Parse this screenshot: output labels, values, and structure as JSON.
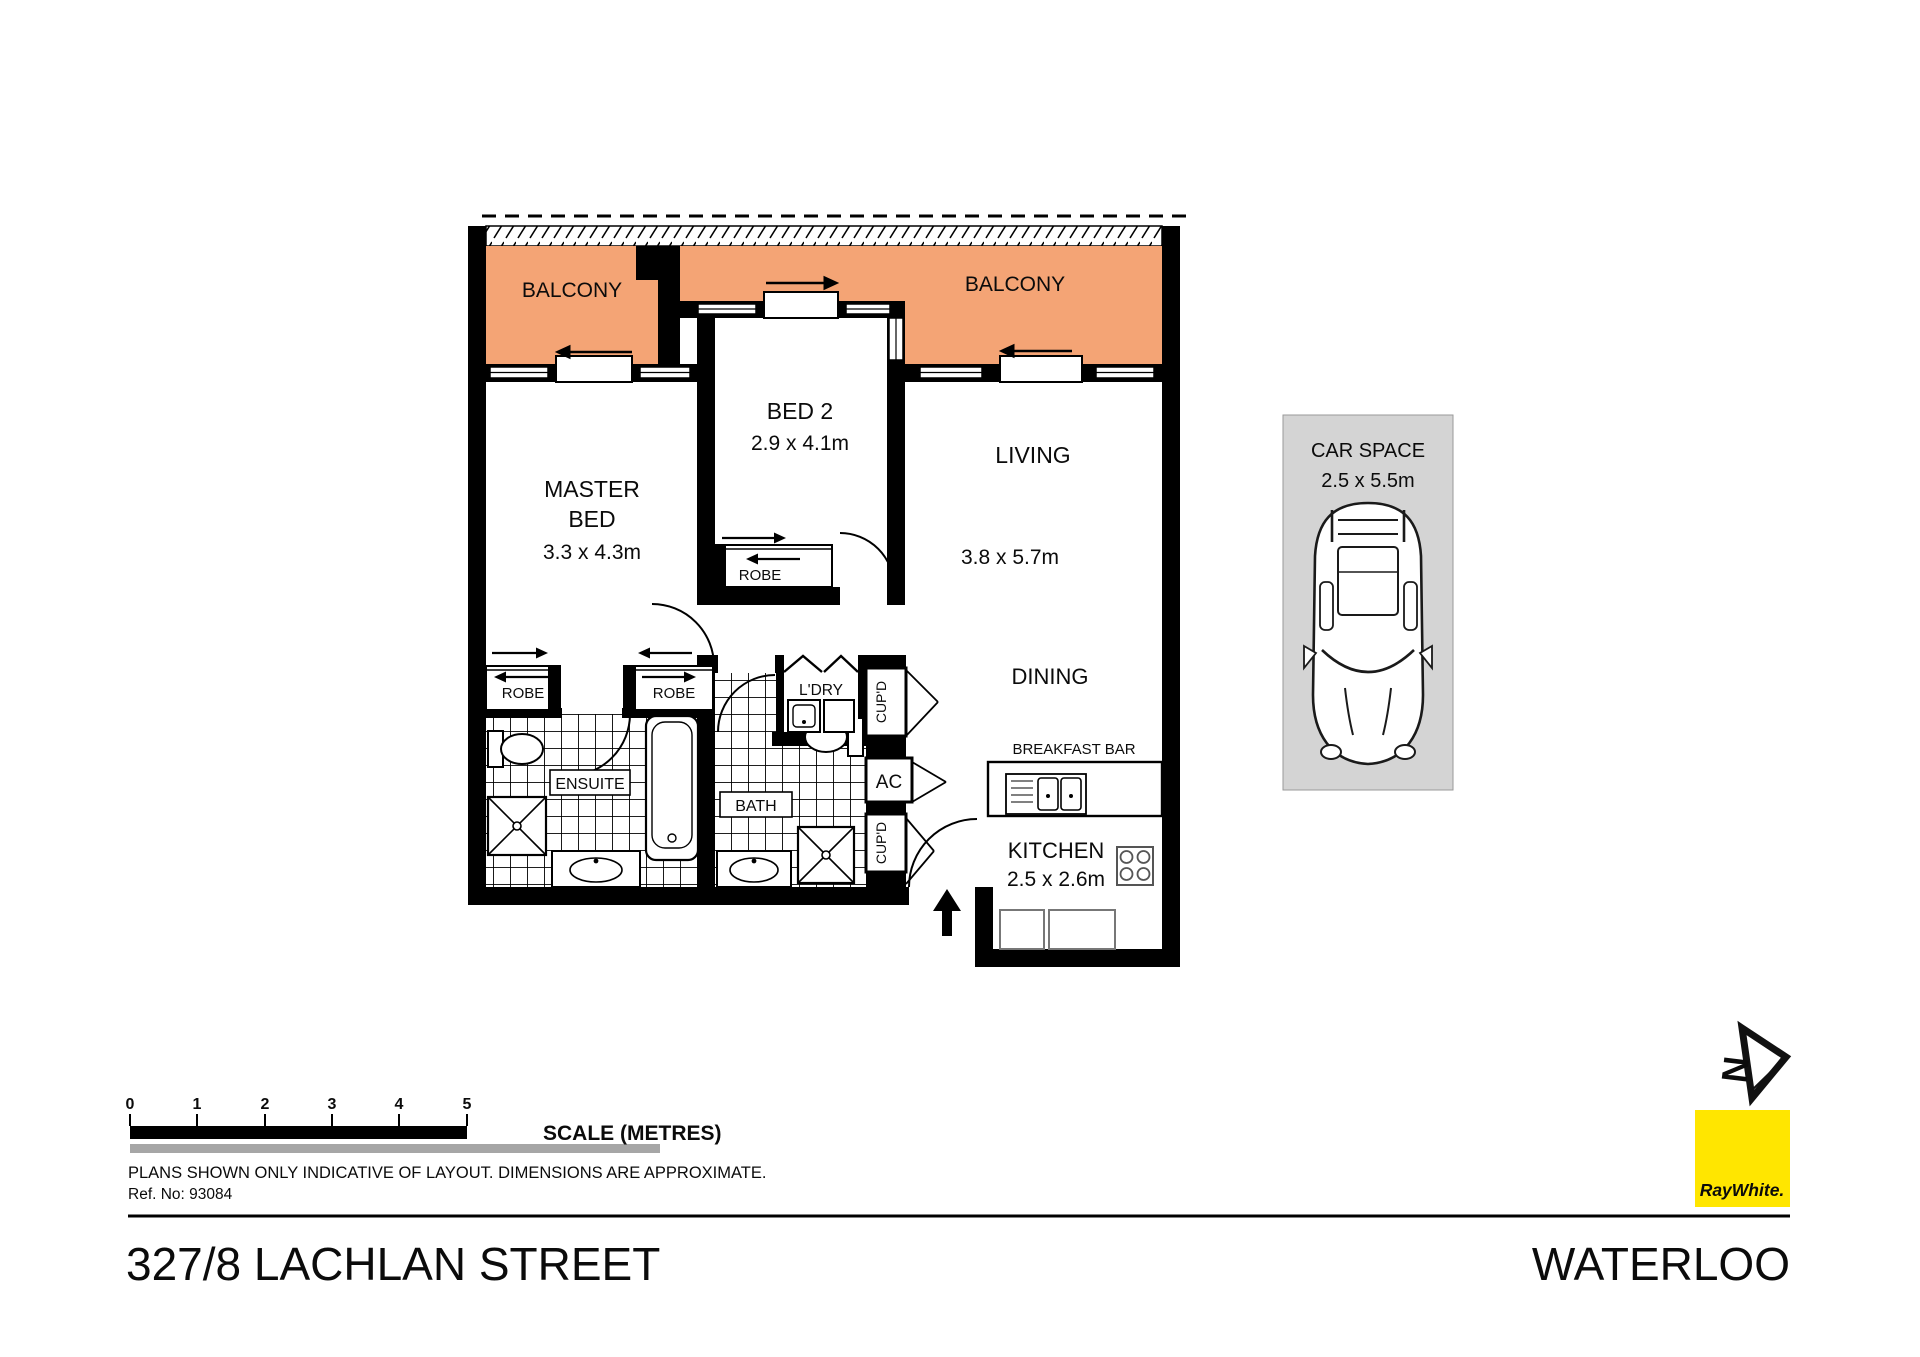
{
  "colors": {
    "balcony_fill": "#F4A475",
    "car_space_fill": "#D4D4D4",
    "logo_yellow": "#FFE600",
    "wall": "#000000",
    "scale_gray_bar": "#A6A6A6"
  },
  "plan": {
    "balcony_left_label": "BALCONY",
    "balcony_right_label": "BALCONY",
    "master_bed": {
      "line1": "MASTER",
      "line2": "BED",
      "dims": "3.3 x 4.3m"
    },
    "bed2": {
      "label": "BED 2",
      "dims": "2.9 x 4.1m"
    },
    "living": {
      "label": "LIVING",
      "dims": "3.8 x 5.7m"
    },
    "dining": {
      "label": "DINING"
    },
    "kitchen": {
      "label": "KITCHEN",
      "dims": "2.5 x 2.6m"
    },
    "breakfast_bar_label": "BREAKFAST BAR",
    "ensuite_label": "ENSUITE",
    "bath_label": "BATH",
    "laundry_label": "L'DRY",
    "ac_label": "AC",
    "cupboard_labels": [
      "CUP'D",
      "CUP'D"
    ],
    "robe_labels": [
      "ROBE",
      "ROBE",
      "ROBE"
    ],
    "car_space": {
      "line1": "CAR SPACE",
      "line2": "2.5 x 5.5m"
    }
  },
  "compass": {
    "north_label": "N"
  },
  "scale_bar": {
    "ticks": [
      "0",
      "1",
      "2",
      "3",
      "4",
      "5"
    ],
    "label": "SCALE (METRES)"
  },
  "footer": {
    "disclaimer": "PLANS SHOWN ONLY INDICATIVE OF LAYOUT.  DIMENSIONS ARE APPROXIMATE.",
    "reference": "Ref. No: 93084",
    "address": "327/8 LACHLAN STREET",
    "suburb": "WATERLOO"
  },
  "branding": {
    "agency_wordmark": "RayWhite."
  }
}
